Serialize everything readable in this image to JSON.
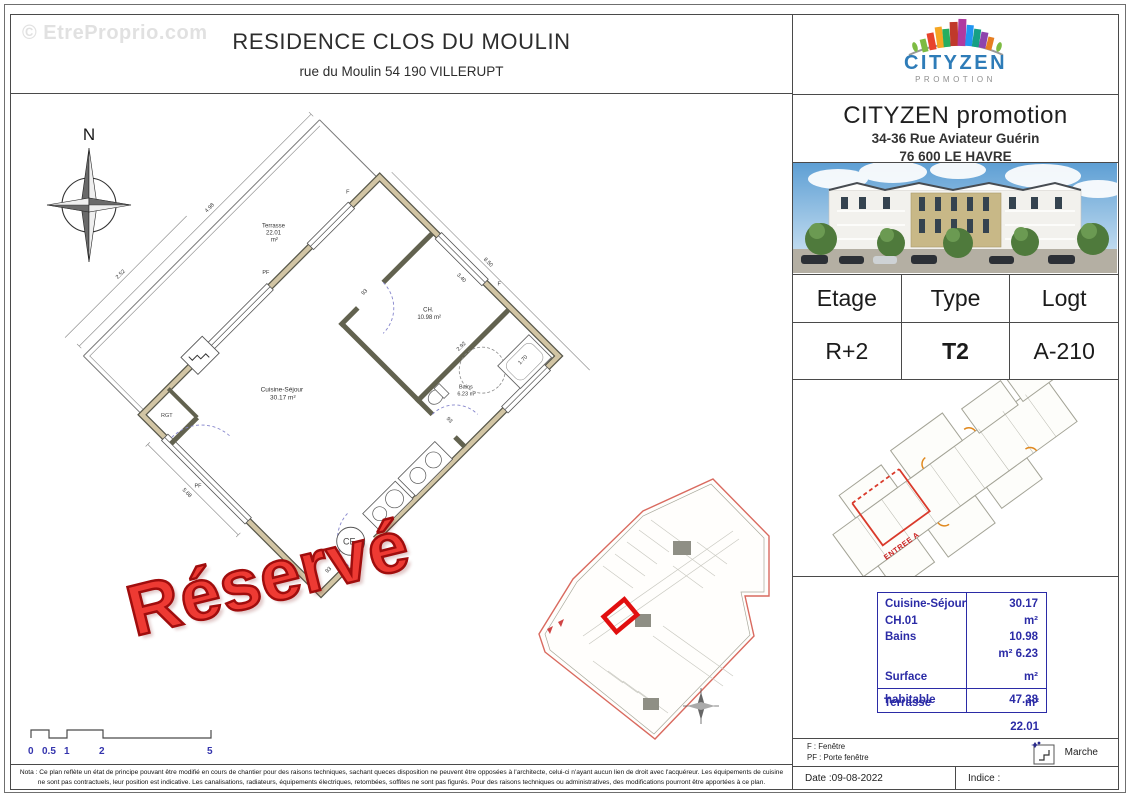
{
  "watermark": {
    "text": "© EtreProprio.com"
  },
  "title_block": {
    "title": "RESIDENCE CLOS DU MOULIN",
    "subtitle": "rue du Moulin 54 190 VILLERUPT"
  },
  "stamp": {
    "text": "Réservé"
  },
  "compass": {
    "north": "N"
  },
  "plan": {
    "rooms": {
      "terrasse": {
        "line1": "Terrasse",
        "line2": "22.01",
        "line3": "m²"
      },
      "ch": {
        "line1": "CH.",
        "line2": "10.98 m²"
      },
      "bains": {
        "line1": "Bains",
        "line2": "6.23 m²"
      },
      "cuisine": {
        "line1": "Cuisine-Séjour",
        "line2": "30.17 m²"
      }
    },
    "labels": {
      "f": "F",
      "pf": "PF",
      "ce": "CE",
      "rgt": "RGT"
    },
    "dims": {
      "nw": "4.98",
      "w": "2.52",
      "sw": "5.68",
      "ne": "8.50",
      "ch_w": "3.40",
      "ch_h": "2.92",
      "tub": "1.70",
      "door1": "93",
      "door2": "93",
      "door3": "93"
    }
  },
  "scale_bar": {
    "ticks": [
      "0",
      "0.5",
      "1",
      "2",
      "5"
    ]
  },
  "company": {
    "logo_name": "CITYZEN",
    "logo_sub": "PROMOTION",
    "name": "CITYZEN promotion",
    "address_line1": "34-36 Rue Aviateur Guérin",
    "address_line2": "76 600 LE HAVRE"
  },
  "info_table": {
    "headers": [
      "Etage",
      "Type",
      "Logt"
    ],
    "values": [
      "R+2",
      "T2",
      "A-210"
    ]
  },
  "key_plan": {
    "entrance": "ENTREE A"
  },
  "surface_table": {
    "col1": [
      "Cuisine-Séjour",
      "CH.01",
      "Bains"
    ],
    "col2": [
      "30.17",
      "m²",
      "10.98",
      "m² 6.23"
    ],
    "surface_label": "Surface",
    "surface_unit": "m²",
    "habitable_label": "habitable",
    "habitable_value": "47.38",
    "terrasse_label": "Terrasse",
    "terrasse_unit": "m²",
    "terrasse_value": "22.01"
  },
  "legend": {
    "f_line": "F : Fenêtre",
    "pf_line": "PF : Porte fenêtre",
    "marche_label": "Marche"
  },
  "footer": {
    "date": "Date :09-08-2022",
    "indice": "Indice :",
    "nota_line1": "Nota : Ce plan reflète un état de principe pouvant être modifié en cours de chantier pour des raisons techniques, sachant queces disposition ne peuvent être opposées à l'architecte, celui-ci n'ayant aucun lien de droit avec l'acquéreur. Les équipements de cuisine",
    "nota_line2": "ne sont pas contractuels, leur position est indicative. Les canalisations, radiateurs, équipements électriques, retombées, soffites ne sont pas figurés. Pour des raisons techniques ou administratives, des modifications pourront être apportées à ce plan."
  },
  "colors": {
    "accent_blue": "#2b2ba6",
    "stamp_red": "#ee3a33",
    "highlight_red": "#e10f0f",
    "logo_blue": "#2e7cb8",
    "wall_beige": "#d2c5a4"
  }
}
